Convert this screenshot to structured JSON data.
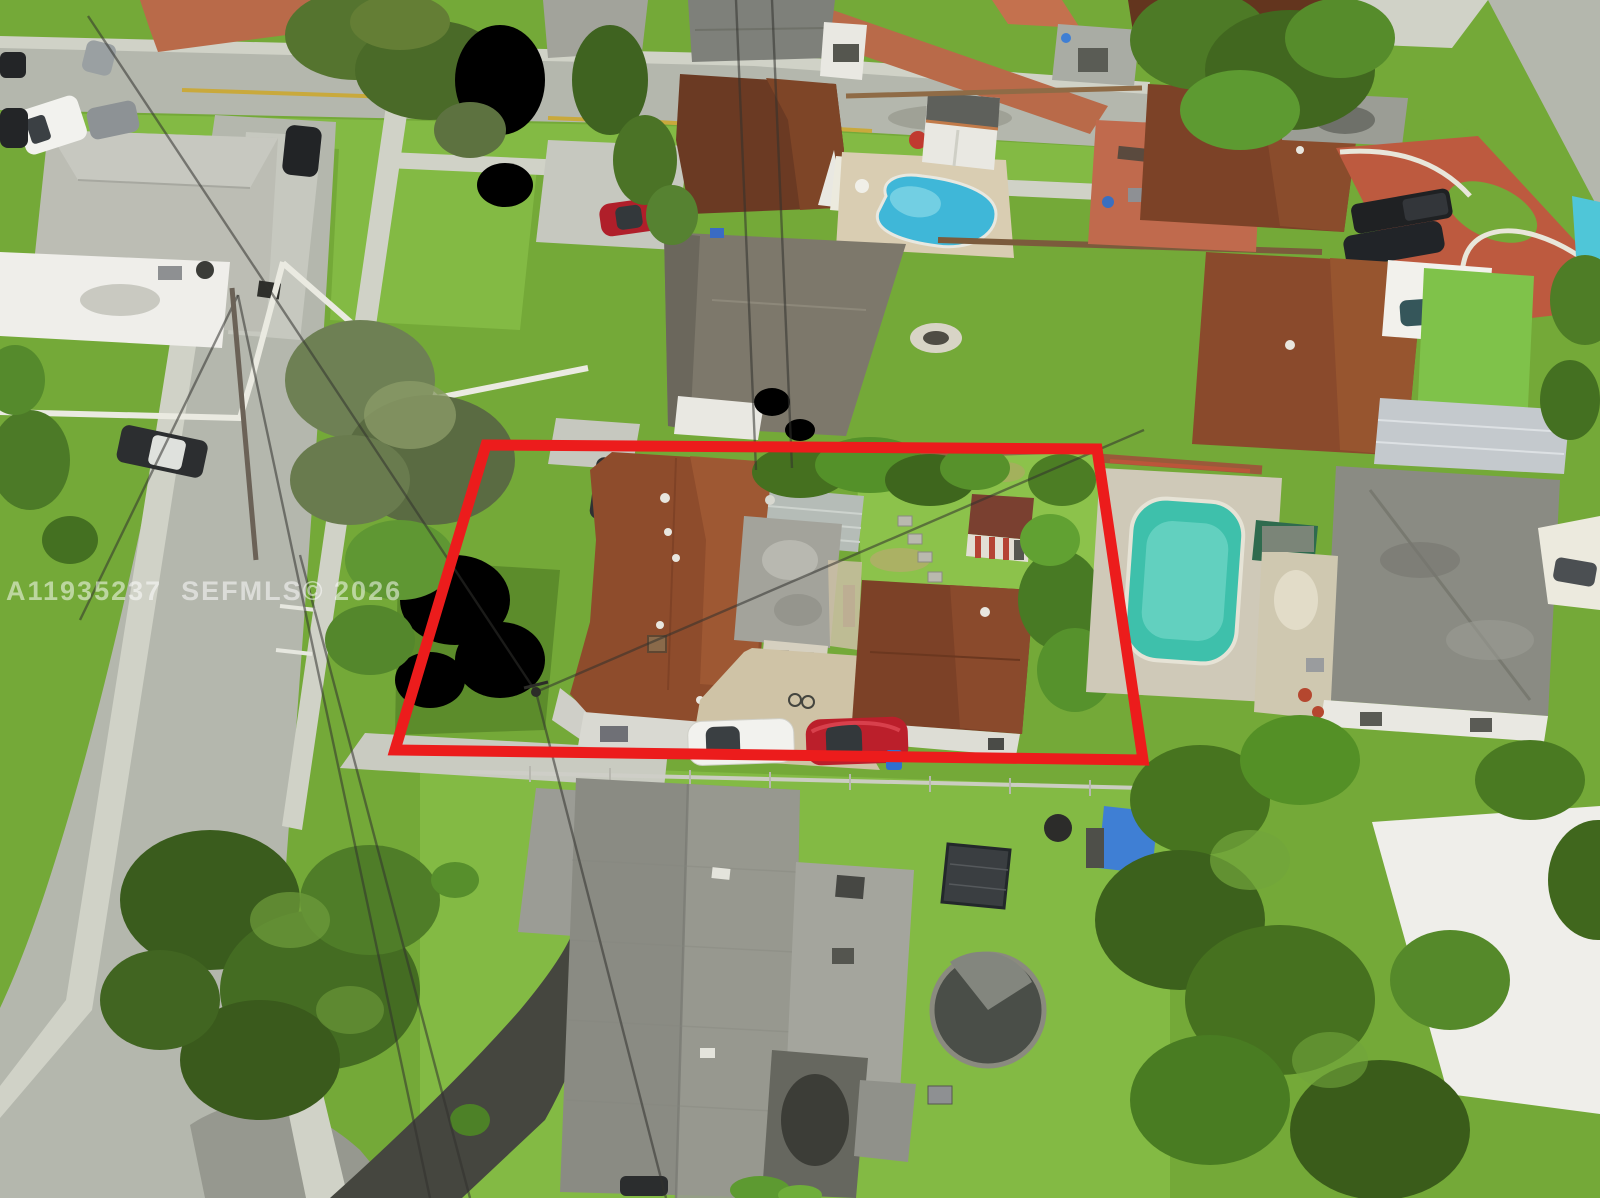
{
  "scene": {
    "type": "aerial-real-estate-photo",
    "description": "Aerial drone photo of a suburban residential neighborhood; a red boundary outline highlights the subject property containing a brown-shingle main house, a gray flat-roof rear unit, a detached brown-roof garage, a small backyard shed, and a white and a red car parked at the bottom edge",
    "features": [
      "subject property with red outline",
      "kidney shaped pool",
      "long rectangular pool",
      "third pool sliver at right edge",
      "red painted driveway",
      "white carport",
      "trampoline pool",
      "curved street with large tree",
      "parked cars",
      "power lines"
    ]
  },
  "watermark": {
    "text": "A11935237  SEFMLS© 2026"
  },
  "outline": {
    "points": "486,445 1097,449 1143,760 395,750",
    "color": "#ec1c1c",
    "stroke_width": 11
  },
  "palette": {
    "grass": "#74a938",
    "grass_light": "#83ba44",
    "grass_dark": "#5c8c2b",
    "grass_bright": "#8cc24b",
    "road": "#b4b7ad",
    "road_dark": "#9a9c92",
    "sidewalk": "#d0d2c7",
    "driveway": "#c6c8bf",
    "asphalt_gray": "#96988f",
    "driveway_black": "#45463f",
    "brick": "#b96a49",
    "red_drive": "#bd5a3f",
    "patio_terracotta": "#c06a4d",
    "roof_subject": "#8e4c2c",
    "roof_subject_light": "#a05a34",
    "roof_garage": "#7c4127",
    "roof_brown": "#6b3a23",
    "roof_gray": "#8a8b83",
    "roof_gray_light": "#a4a59d",
    "roof_gravel": "#bcbdb4",
    "roof_white": "#efeeea",
    "roof_metal": "#b5bcb7",
    "roof_tan": "#cfc8b0",
    "wall_white": "#e9e8e2",
    "wall_cream": "#ded8c6",
    "pool_blue": "#3fb7d8",
    "pool_blue_light": "#7fd4e6",
    "pool_teal": "#3ec0ab",
    "pool_teal_light": "#6fd6c6",
    "pool_edge_blue": "#4fc6d8",
    "sand": "#d9cdb2",
    "turf": "#7fc24a",
    "paver": "#c4c9cd",
    "car_white": "#f2f2ee",
    "car_red": "#bb1f2b",
    "car_dark": "#232527",
    "car_gray": "#8d9295",
    "car_teal": "#35565a",
    "fence_white": "#eaeae1",
    "fence_wood": "#8f6b46",
    "wire": "#32322e",
    "outline_red": "#ec1c1c",
    "watermark": "rgba(255,255,255,0.52)",
    "marking_yellow": "#c9a93c"
  }
}
